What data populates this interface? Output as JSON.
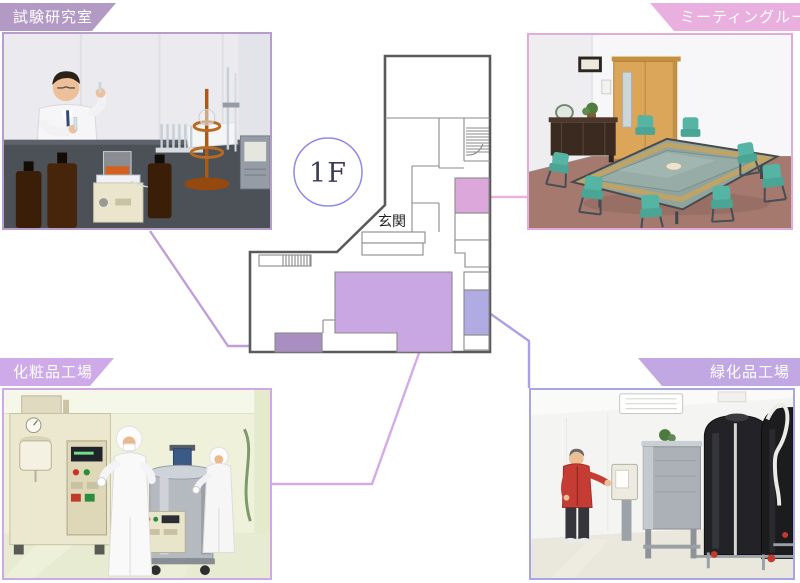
{
  "page": {
    "background": "#ffffff"
  },
  "plan": {
    "floor_badge": "1F",
    "entrance_label": "玄関",
    "outer_wall_color": "#5a5a5c",
    "inner_wall_color": "#8a8a8a",
    "badge_ring_color": "#9189e9",
    "badge_text_color": "#3b3b58",
    "entrance_text_color": "#1c1c1c",
    "room_colors": {
      "meeting_room": "#dca7db",
      "cosmetics_factory": "#c9a7e2",
      "test_lab": "#a98fc1",
      "greening_factory": "#b0abe2"
    }
  },
  "sections": [
    {
      "id": "test-lab",
      "label": "試験研究室",
      "position": "top-left",
      "tab_color": "#b29ac5",
      "frame_color": "#b79dca",
      "connector_color": "#c0a0d5"
    },
    {
      "id": "meeting-room",
      "label": "ミーティングルーム",
      "position": "top-right",
      "tab_color": "#e9afde",
      "frame_color": "#e3abda",
      "connector_color": "#e9b3dd"
    },
    {
      "id": "cosmetics-factory",
      "label": "化粧品工場",
      "position": "bottom-left",
      "tab_color": "#cfaae8",
      "frame_color": "#cfa9e6",
      "connector_color": "#d5aae8"
    },
    {
      "id": "greening-factory",
      "label": "緑化品工場",
      "position": "bottom-right",
      "tab_color": "#c1a8e2",
      "frame_color": "#a9a4e5",
      "connector_color": "#aaa2e8"
    }
  ]
}
